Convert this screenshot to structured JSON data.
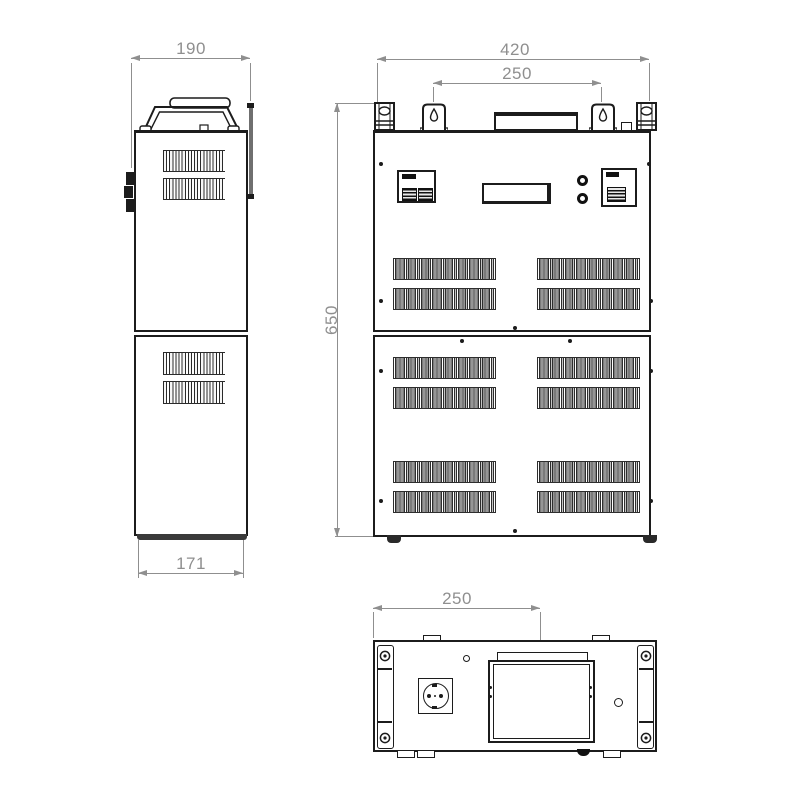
{
  "dims": {
    "side_width": "190",
    "side_depth": "171",
    "front_width": "420",
    "front_mount_spacing": "250",
    "front_height": "650",
    "bottom_plate_offset": "250"
  },
  "colors": {
    "line": "#1c1c1c",
    "dimension": "#8f8f8f",
    "background": "#ffffff"
  }
}
